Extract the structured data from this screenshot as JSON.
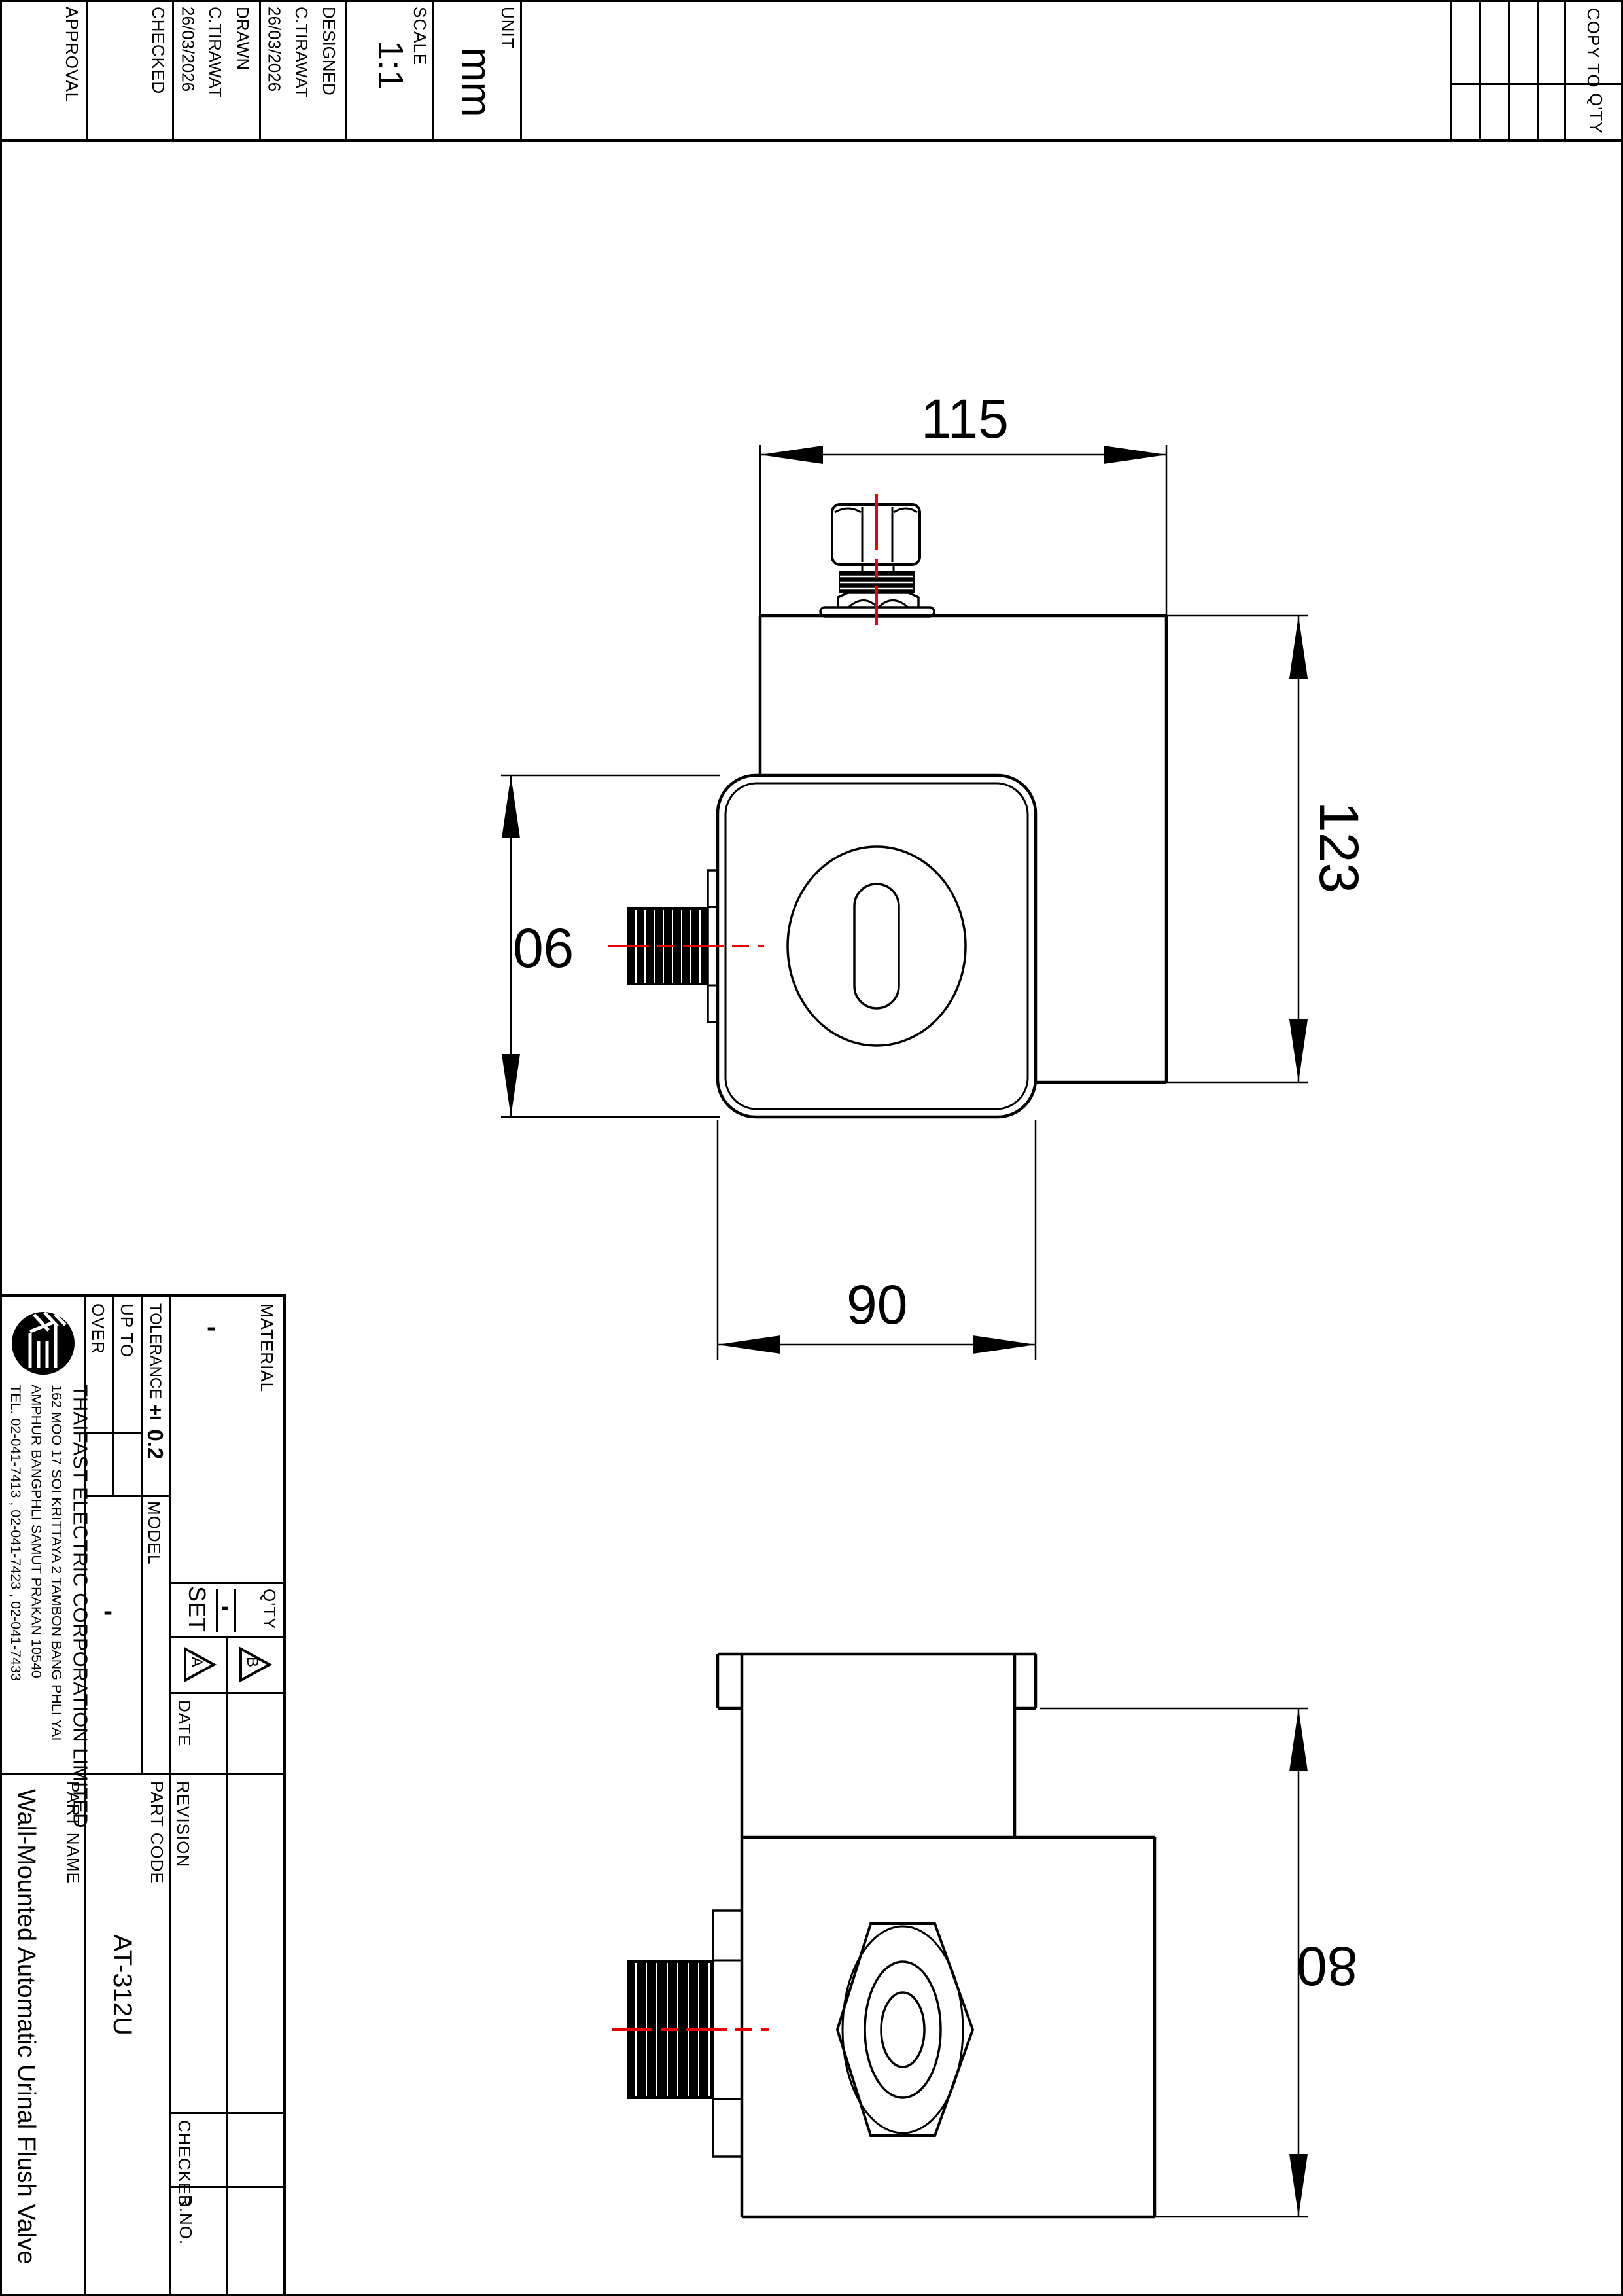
{
  "sheet_header": {
    "approval_label": "APPROVAL",
    "checked_label": "CHECKED",
    "drawn": {
      "label": "DRAWN",
      "name": "C.TIRAWAT",
      "date": "26/03/2026"
    },
    "designed": {
      "label": "DESIGNED",
      "name": "C.TIRAWAT",
      "date": "26/03/2026"
    },
    "scale": {
      "label": "SCALE",
      "value": "1:1"
    },
    "unit": {
      "label": "UNIT",
      "value": "mm"
    },
    "copy_table": {
      "copy_to_label": "COPY TO",
      "qty_label": "Q'TY"
    }
  },
  "drawing": {
    "dims": {
      "width": "115",
      "depth": "123",
      "face_height": "90",
      "face_width": "90",
      "side_height": "80"
    }
  },
  "title_block": {
    "company": {
      "name": "THAIFAST ELECTRIC CORPORATION LIMITED",
      "address1": "162 MOO 17 SOI KRITTAYA 2 TAMBON BANG PHLI YAI",
      "address2": "AMPHUR BANGPHLI SAMUT PRAKAN 10540",
      "tel": "TEL. 02-041-7413 , 02-041-7423 , 02-041-7433"
    },
    "logo_name": "thaifast-te-logo",
    "tolerance": {
      "over_label": "OVER",
      "up_to_label": "UP TO",
      "label": "TOLERANCE",
      "value": "± 0.2"
    },
    "material": {
      "label": "MATERIAL",
      "value": "-"
    },
    "model": {
      "label": "MODEL",
      "value": "-"
    },
    "set": {
      "label": "SET",
      "value": "-",
      "qty_label": "Q'TY"
    },
    "rev_marks": {
      "a": "A",
      "b": "B"
    },
    "date_label": "DATE",
    "revision_label": "REVISION",
    "part_code": {
      "label": "PART CODE",
      "value": "AT-312U"
    },
    "part_name": {
      "label": "PART NAME",
      "value": "Wall-Mounted Automatic Urinal Flush Valve"
    },
    "checked_label": "CHECKED",
    "rno_label": "R.NO."
  }
}
